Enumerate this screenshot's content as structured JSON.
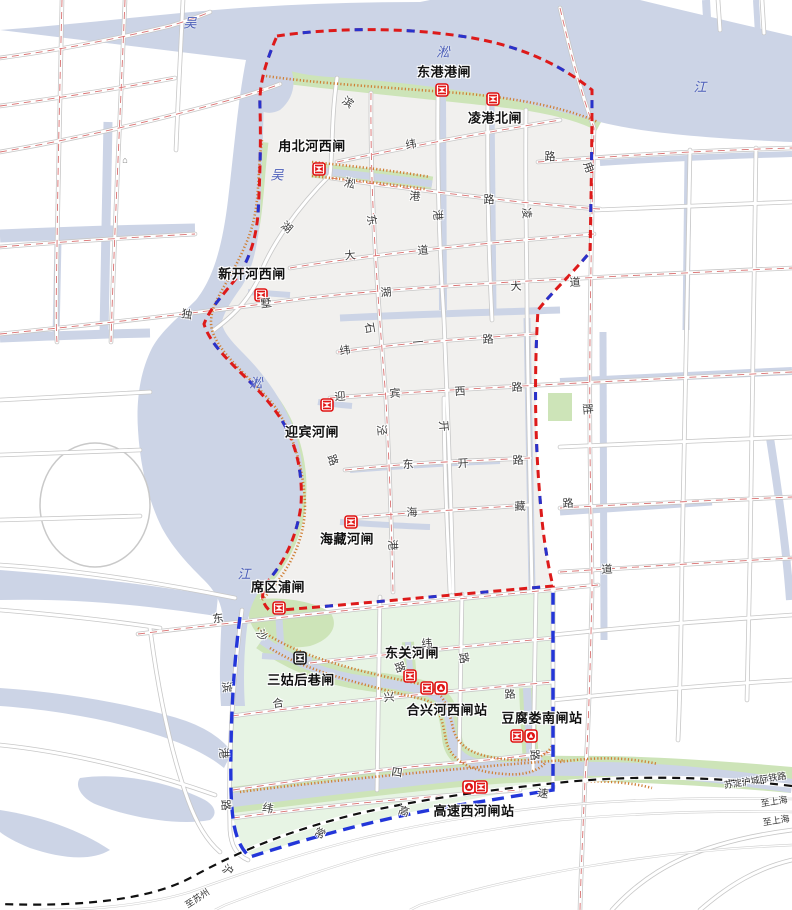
{
  "title": "吴淞江片区水闸泵站分布图",
  "colors": {
    "boundary_red": "#dd1a1a",
    "boundary_blue": "#2733cc",
    "pure_blue_dash": "#2336d9",
    "water": "#ccd4e6",
    "green_strip": "#cde4b8",
    "south_zone": "#e7f4e4",
    "urban_zone": "#f1f0ee",
    "levee_orange": "#cf7f35",
    "road_centerline": "#d97070",
    "gate_red": "#e01212",
    "gate_black": "#1a1a1a",
    "railway_black": "#111111"
  },
  "gates": [
    {
      "name": "东港港闸",
      "label_x": 444,
      "label_y": 71,
      "icons": [
        {
          "type": "gate",
          "color": "red",
          "x": 442,
          "y": 90
        }
      ]
    },
    {
      "name": "凌港北闸",
      "label_x": 495,
      "label_y": 117,
      "icons": [
        {
          "type": "gate",
          "color": "red",
          "x": 493,
          "y": 99
        }
      ]
    },
    {
      "name": "甪北河西闸",
      "label_x": 312,
      "label_y": 145,
      "icons": [
        {
          "type": "gate",
          "color": "red",
          "x": 319,
          "y": 169
        }
      ]
    },
    {
      "name": "新开河西闸",
      "label_x": 252,
      "label_y": 273,
      "icons": [
        {
          "type": "gate",
          "color": "red",
          "x": 261,
          "y": 295
        }
      ]
    },
    {
      "name": "迎宾河闸",
      "label_x": 312,
      "label_y": 431,
      "icons": [
        {
          "type": "gate",
          "color": "red",
          "x": 327,
          "y": 405
        }
      ]
    },
    {
      "name": "海藏河闸",
      "label_x": 347,
      "label_y": 538,
      "icons": [
        {
          "type": "gate",
          "color": "red",
          "x": 351,
          "y": 522
        }
      ]
    },
    {
      "name": "席区浦闸",
      "label_x": 278,
      "label_y": 586,
      "icons": [
        {
          "type": "gate",
          "color": "red",
          "x": 279,
          "y": 608
        }
      ]
    },
    {
      "name": "三姑后巷闸",
      "label_x": 301,
      "label_y": 679,
      "icons": [
        {
          "type": "gate",
          "color": "black",
          "x": 300,
          "y": 658
        }
      ]
    },
    {
      "name": "东关河闸",
      "label_x": 412,
      "label_y": 652,
      "icons": [
        {
          "type": "gate",
          "color": "red",
          "x": 410,
          "y": 676
        }
      ]
    },
    {
      "name": "合兴河西闸站",
      "label_x": 447,
      "label_y": 709,
      "icons": [
        {
          "type": "gate",
          "color": "red",
          "x": 427,
          "y": 688
        },
        {
          "type": "pump",
          "color": "red",
          "x": 441,
          "y": 688
        }
      ]
    },
    {
      "name": "豆腐娄南闸站",
      "label_x": 542,
      "label_y": 717,
      "icons": [
        {
          "type": "gate",
          "color": "red",
          "x": 517,
          "y": 736
        },
        {
          "type": "pump",
          "color": "red",
          "x": 531,
          "y": 736
        }
      ]
    },
    {
      "name": "高速西河闸站",
      "label_x": 474,
      "label_y": 810,
      "icons": [
        {
          "type": "pump",
          "color": "red",
          "x": 469,
          "y": 787
        },
        {
          "type": "gate",
          "color": "red",
          "x": 481,
          "y": 787
        }
      ]
    }
  ],
  "river_labels": [
    {
      "t": "吴",
      "x": 190,
      "y": 22
    },
    {
      "t": "淞",
      "x": 443,
      "y": 51
    },
    {
      "t": "江",
      "x": 700,
      "y": 86
    },
    {
      "t": "吴",
      "x": 277,
      "y": 174
    },
    {
      "t": "淞",
      "x": 256,
      "y": 382
    },
    {
      "t": "江",
      "x": 244,
      "y": 573
    }
  ],
  "road_labels": [
    {
      "t": "滨",
      "x": 348,
      "y": 102,
      "r": 35
    },
    {
      "t": "纬",
      "x": 411,
      "y": 144,
      "r": -10
    },
    {
      "t": "淞",
      "x": 350,
      "y": 183,
      "r": 15
    },
    {
      "t": "港",
      "x": 415,
      "y": 196,
      "r": 5
    },
    {
      "t": "路",
      "x": 489,
      "y": 199,
      "r": 0
    },
    {
      "t": "东",
      "x": 372,
      "y": 220,
      "r": 80
    },
    {
      "t": "港",
      "x": 438,
      "y": 215,
      "r": 85
    },
    {
      "t": "湖",
      "x": 287,
      "y": 227,
      "r": 40
    },
    {
      "t": "大",
      "x": 350,
      "y": 255,
      "r": -5
    },
    {
      "t": "道",
      "x": 423,
      "y": 250,
      "r": -5
    },
    {
      "t": "凌",
      "x": 527,
      "y": 213,
      "r": 85
    },
    {
      "t": "甪",
      "x": 589,
      "y": 167,
      "r": 70
    },
    {
      "t": "路",
      "x": 550,
      "y": 156,
      "r": 0
    },
    {
      "t": "独",
      "x": 187,
      "y": 314,
      "r": 10
    },
    {
      "t": "墅",
      "x": 266,
      "y": 303,
      "r": -8
    },
    {
      "t": "湖",
      "x": 386,
      "y": 292,
      "r": -5
    },
    {
      "t": "大",
      "x": 516,
      "y": 286,
      "r": -3
    },
    {
      "t": "道",
      "x": 575,
      "y": 282,
      "r": -3
    },
    {
      "t": "石",
      "x": 370,
      "y": 328,
      "r": 80
    },
    {
      "t": "纬",
      "x": 345,
      "y": 350,
      "r": -8
    },
    {
      "t": "一",
      "x": 418,
      "y": 342,
      "r": -5
    },
    {
      "t": "路",
      "x": 488,
      "y": 339,
      "r": -3
    },
    {
      "t": "迎",
      "x": 340,
      "y": 396,
      "r": -5
    },
    {
      "t": "宾",
      "x": 395,
      "y": 393,
      "r": -3
    },
    {
      "t": "西",
      "x": 460,
      "y": 391,
      "r": -3
    },
    {
      "t": "路",
      "x": 517,
      "y": 387,
      "r": -3
    },
    {
      "t": "泾",
      "x": 382,
      "y": 430,
      "r": 85
    },
    {
      "t": "路",
      "x": 333,
      "y": 460,
      "r": 70
    },
    {
      "t": "开",
      "x": 444,
      "y": 426,
      "r": 85
    },
    {
      "t": "东",
      "x": 408,
      "y": 464,
      "r": -3
    },
    {
      "t": "开",
      "x": 463,
      "y": 463,
      "r": -3
    },
    {
      "t": "路",
      "x": 518,
      "y": 460,
      "r": -3
    },
    {
      "t": "海",
      "x": 412,
      "y": 512,
      "r": -3
    },
    {
      "t": "藏",
      "x": 520,
      "y": 506,
      "r": -3
    },
    {
      "t": "港",
      "x": 393,
      "y": 545,
      "r": 85
    },
    {
      "t": "胜",
      "x": 588,
      "y": 409,
      "r": 85
    },
    {
      "t": "路",
      "x": 568,
      "y": 503,
      "r": -3
    },
    {
      "t": "道",
      "x": 607,
      "y": 569,
      "r": -3
    },
    {
      "t": "东",
      "x": 218,
      "y": 618,
      "r": -8
    },
    {
      "t": "沙",
      "x": 262,
      "y": 635,
      "r": 60
    },
    {
      "t": "滨",
      "x": 227,
      "y": 687,
      "r": 85
    },
    {
      "t": "港",
      "x": 224,
      "y": 753,
      "r": 85
    },
    {
      "t": "路",
      "x": 226,
      "y": 805,
      "r": 85
    },
    {
      "t": "纬",
      "x": 427,
      "y": 643,
      "r": -5
    },
    {
      "t": "路",
      "x": 464,
      "y": 658,
      "r": 80
    },
    {
      "t": "路",
      "x": 400,
      "y": 667,
      "r": 70
    },
    {
      "t": "合",
      "x": 278,
      "y": 703,
      "r": -8
    },
    {
      "t": "兴",
      "x": 389,
      "y": 697,
      "r": -5
    },
    {
      "t": "路",
      "x": 510,
      "y": 694,
      "r": -5
    },
    {
      "t": "路",
      "x": 535,
      "y": 755,
      "r": 85
    },
    {
      "t": "四",
      "x": 397,
      "y": 772,
      "r": 8
    },
    {
      "t": "纬",
      "x": 268,
      "y": 808,
      "r": 12
    },
    {
      "t": "高",
      "x": 404,
      "y": 811,
      "r": 18
    },
    {
      "t": "速",
      "x": 543,
      "y": 793,
      "r": 8
    },
    {
      "t": "常",
      "x": 320,
      "y": 833,
      "r": 25
    },
    {
      "t": "沪",
      "x": 228,
      "y": 870,
      "r": 35
    }
  ],
  "railway": {
    "name": "苏淀沪城际铁路",
    "name_x": 755,
    "name_y": 780,
    "name_r": -9,
    "destinations": [
      {
        "t": "至上海",
        "x": 774,
        "y": 801,
        "r": -9
      },
      {
        "t": "至上海",
        "x": 776,
        "y": 820,
        "r": -9
      },
      {
        "t": "至苏州",
        "x": 197,
        "y": 898,
        "r": -33
      }
    ]
  },
  "misc_icons": [
    {
      "name": "building-icon",
      "t": "⌂",
      "x": 125,
      "y": 160
    }
  ]
}
